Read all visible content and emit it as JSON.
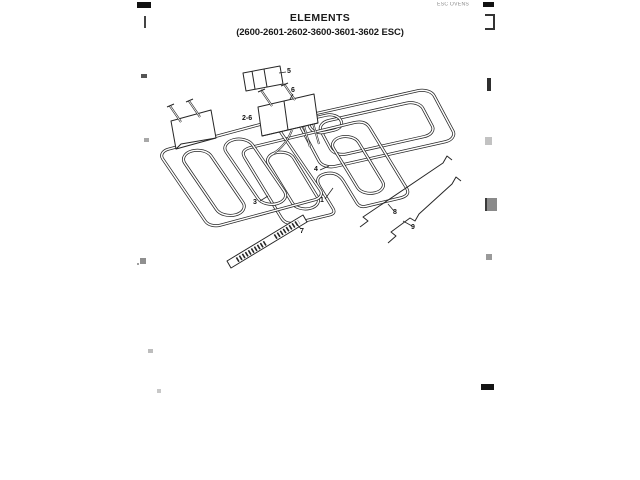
{
  "page": {
    "title": "ELEMENTS",
    "subtitle": "(2600-2601-2602-3600-3601-3602 ESC)",
    "header_note": "ESC OVENS"
  },
  "diagram": {
    "description": "Exploded line drawing of oven heating elements with mounting hardware",
    "callouts": [
      {
        "label": "5"
      },
      {
        "label": "6"
      },
      {
        "label": "2-6"
      },
      {
        "label": "3"
      },
      {
        "label": "1"
      },
      {
        "label": "4"
      },
      {
        "label": "7"
      },
      {
        "label": "8"
      },
      {
        "label": "9"
      }
    ]
  },
  "colors": {
    "ink": "#262626",
    "paper": "#ffffff",
    "faint_note": "#8a8a8a"
  }
}
